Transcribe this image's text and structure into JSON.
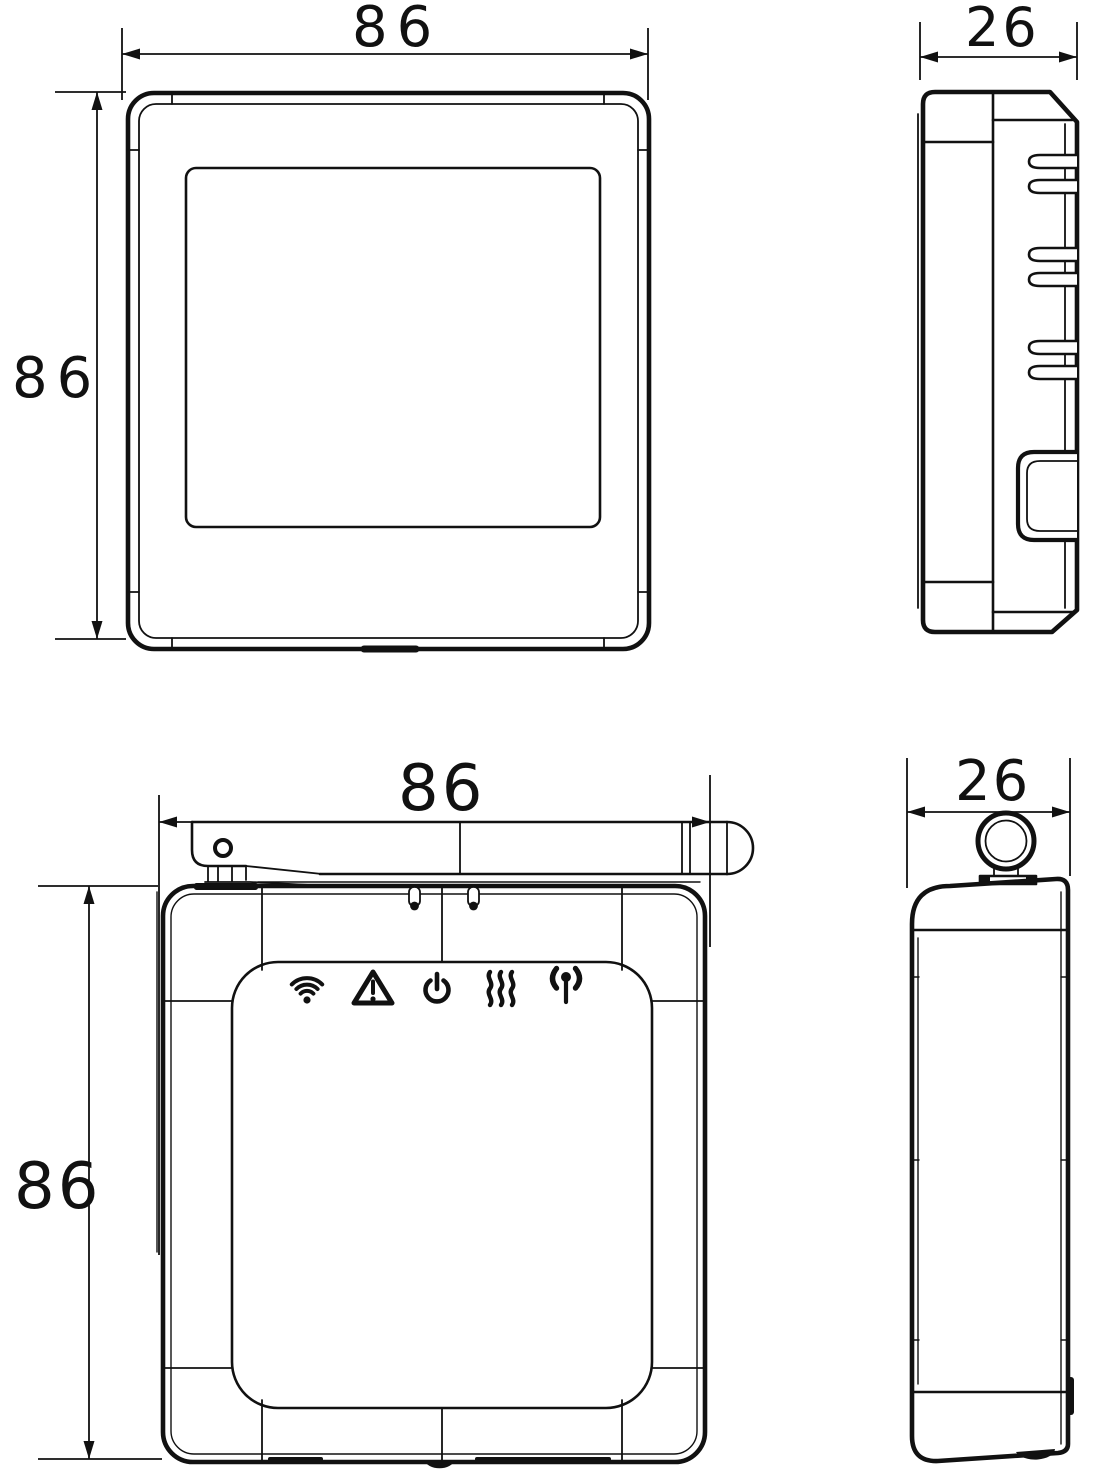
{
  "drawing": {
    "type": "technical-dimension-drawing",
    "subject": "wifi-thermostat-and-rf-receiver",
    "colors": {
      "line": "#111111",
      "background": "#ffffff"
    },
    "views": {
      "thermostat_front": {
        "name": "thermostat front view",
        "width_label": "86",
        "height_label": "86"
      },
      "thermostat_side": {
        "name": "thermostat side view",
        "depth_label": "26"
      },
      "receiver_front": {
        "name": "receiver front view",
        "width_label": "86",
        "height_label": "86"
      },
      "receiver_side": {
        "name": "receiver side view",
        "depth_label": "26"
      }
    },
    "receiver_status_icons": [
      {
        "name": "wifi-icon"
      },
      {
        "name": "warning-icon"
      },
      {
        "name": "power-icon"
      },
      {
        "name": "heating-icon"
      },
      {
        "name": "rf-antenna-icon"
      }
    ]
  }
}
